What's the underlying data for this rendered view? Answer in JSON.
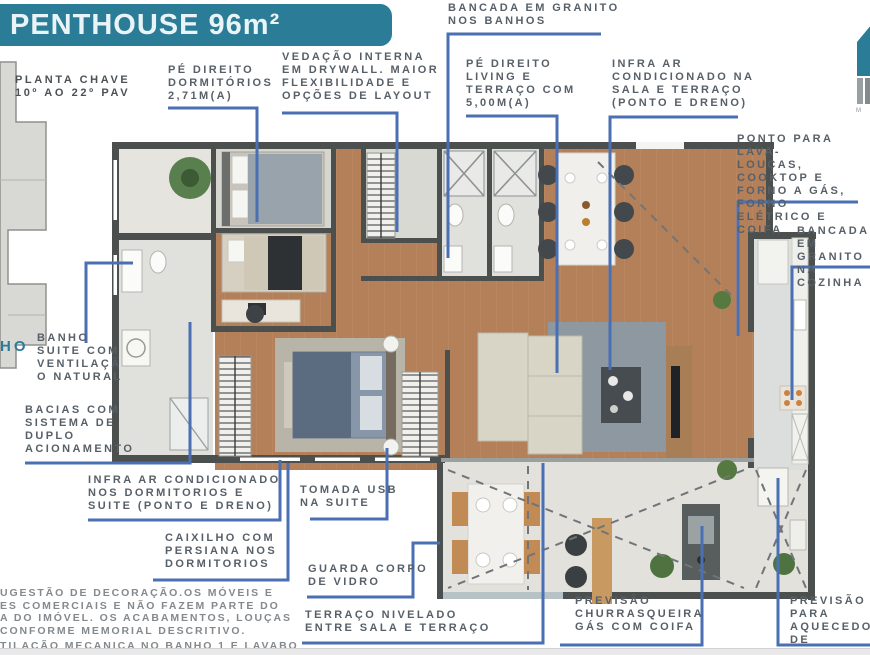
{
  "header": {
    "title": "PENTHOUSE 96m²"
  },
  "key_plan": {
    "title_lines": [
      "PLANTA CHAVE",
      "10º AO 22º PAV"
    ],
    "partial_label": "HO"
  },
  "logo": {
    "caption": "M"
  },
  "callouts": [
    {
      "id": "pe-direito-dormitorios",
      "lines": [
        "PÉ DIREITO",
        "DORMITÓRIOS",
        "2,71M(A)"
      ]
    },
    {
      "id": "vedacao-drywall",
      "lines": [
        "VEDAÇÃO INTERNA",
        "EM DRYWALL. MAIOR",
        "FLEXIBILIDADE E",
        "OPÇÕES DE LAYOUT"
      ]
    },
    {
      "id": "bancada-banhos",
      "lines": [
        "BANCADA EM GRANITO",
        "NOS BANHOS"
      ]
    },
    {
      "id": "pe-direito-living",
      "lines": [
        "PÉ DIREITO",
        "LIVING E",
        "TERRAÇO COM",
        "5,00M(A)"
      ]
    },
    {
      "id": "infra-ar-sala",
      "lines": [
        "INFRA AR",
        "CONDICIONADO NA",
        "SALA E TERRAÇO",
        "(PONTO E DRENO)"
      ]
    },
    {
      "id": "ponto-lava-loucas",
      "lines": [
        "PONTO PARA LAVA-",
        "LOUÇAS, COOKTOP E",
        "FORNO A GÁS, FORNO",
        "ELÉTRICO E COIFA"
      ]
    },
    {
      "id": "bancada-cozinha",
      "lines": [
        "BANCADA EM",
        "GRANITO NA",
        "COZINHA"
      ]
    },
    {
      "id": "banho-suite",
      "lines": [
        "BANHO",
        "SUITE COM",
        "VENTILAÇÃ",
        "O NATURAL"
      ]
    },
    {
      "id": "bacias-duplo-acionamento",
      "lines": [
        "BACIAS COM",
        "SISTEMA DE",
        "DUPLO",
        "ACIONAMENTO"
      ]
    },
    {
      "id": "infra-ar-dormitorios",
      "lines": [
        "INFRA AR CONDICIONADO",
        "NOS DORMITORIOS E",
        "SUITE (PONTO E DRENO)"
      ]
    },
    {
      "id": "caixilho-persiana",
      "lines": [
        "CAIXILHO COM",
        "PERSIANA NOS",
        "DORMITORIOS"
      ]
    },
    {
      "id": "tomada-usb",
      "lines": [
        "TOMADA USB",
        "NA SUITE"
      ]
    },
    {
      "id": "guarda-corpo-vidro",
      "lines": [
        "GUARDA CORPO",
        "DE VIDRO"
      ]
    },
    {
      "id": "terraco-nivelado",
      "lines": [
        "TERRAÇO NIVELADO",
        "ENTRE SALA E TERRAÇO"
      ]
    },
    {
      "id": "previsao-churrasqueira",
      "lines": [
        "PREVISÃO",
        "CHURRASQUEIRA",
        "GÁS COM COIFA"
      ]
    },
    {
      "id": "previsao-aquecedor",
      "lines": [
        "PREVISÃO PARA",
        "AQUECEDOR DE",
        "PASSAGEM"
      ]
    }
  ],
  "disclaimer": {
    "paragraph_lines": [
      "UGESTÃO DE DECORAÇÃO.OS MÓVEIS E",
      "ES COMERCIAIS E NÃO FAZEM PARTE DO",
      "A DO IMÓVEL. OS ACABAMENTOS, LOUÇAS",
      "CONFORME MEMORIAL DESCRITIVO."
    ],
    "note": "TILAÇÃO MECANICA NO BANHO 1 E LAVABO"
  },
  "colors": {
    "accent_teal": "#2b7c96",
    "callout_blue": "#4a6fb3",
    "wall": "#4b4f4d",
    "wood_floor": "#b3805a",
    "label_text": "#575f68"
  }
}
